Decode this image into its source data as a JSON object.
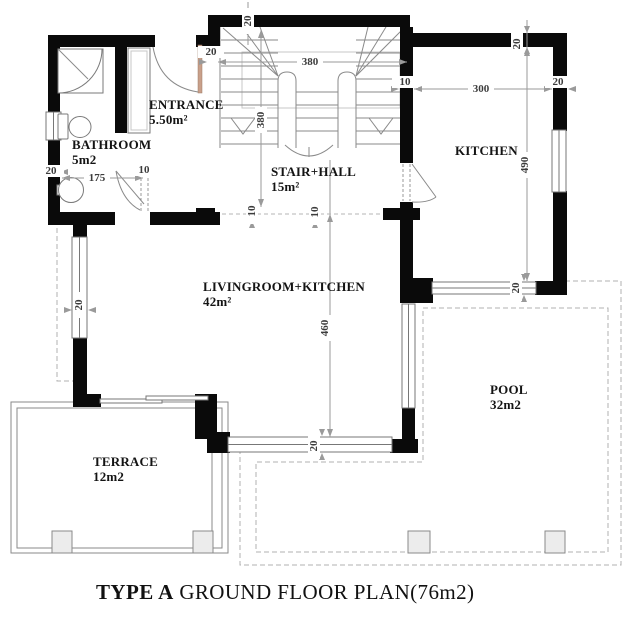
{
  "title": {
    "type": "TYPE A",
    "rest": " GROUND FLOOR PLAN(76m2)"
  },
  "rooms": {
    "bathroom": {
      "name": "BATHROOM",
      "area": "5m2"
    },
    "entrance": {
      "name": "ENTRANCE",
      "area": "5.50m²"
    },
    "stair_hall": {
      "name": "STAIR+HALL",
      "area": "15m²"
    },
    "kitchen": {
      "name": "KITCHEN"
    },
    "livingroom": {
      "name": "LIVINGROOM+KITCHEN",
      "area": "42m²"
    },
    "terrace": {
      "name": "TERRACE",
      "area": "12m2"
    },
    "pool": {
      "name": "POOL",
      "area": "32m2"
    }
  },
  "dims": {
    "stair_width": "380",
    "stair_depth": "380",
    "kitchen_width": "300",
    "kitchen_depth": "490",
    "living_depth": "460",
    "bathroom_width": "175",
    "wall_top_stair": "20",
    "wall_top_kitchen": "20",
    "wall_stair_left": "20",
    "wall_hall_kitchen": "10",
    "wall_kitchen_right": "20",
    "wall_bath_left": "20",
    "door_bath": "10",
    "window_living_left": "20",
    "hall_opening_a": "10",
    "hall_opening_b": "10",
    "window_living_bottom": "20",
    "window_kitchen_bottom": "20"
  },
  "colors": {
    "wall": "#0a0a0a",
    "line": "#8a8a8a",
    "dash": "#b0b0b0",
    "door_leaf": "#c9a08a"
  }
}
